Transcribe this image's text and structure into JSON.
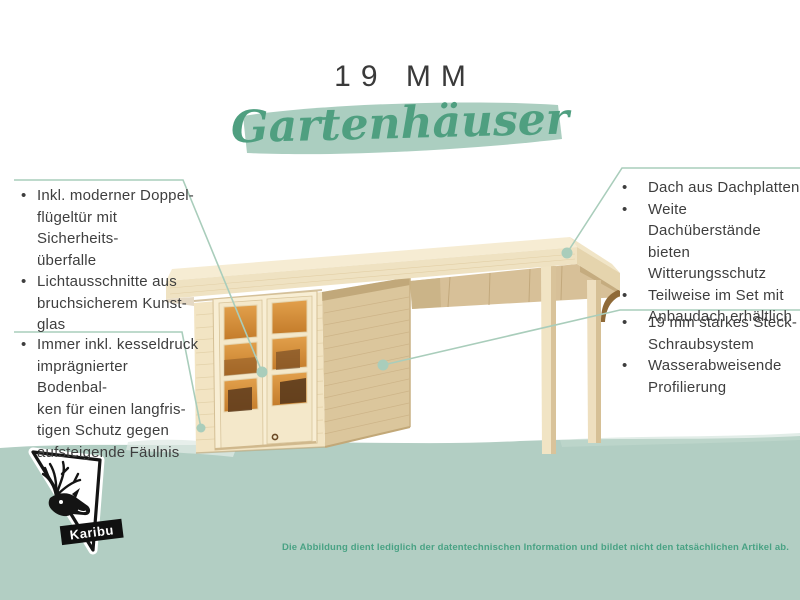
{
  "header": {
    "size_label": "19 MM",
    "product_line": "Gartenhäuser"
  },
  "features": {
    "left_top": [
      "Inkl. moderner Doppel-\nflügeltür mit Sicherheits-\nüberfalle",
      "Lichtausschnitte aus\nbruchsicherem Kunst-\nglas"
    ],
    "left_bottom": [
      "Immer inkl. kesseldruck\nimprägnierter Bodenbal-\nken für einen langfris-\ntigen Schutz gegen\naufsteigende Fäulnis"
    ],
    "right_top": [
      "Dach aus Dachplatten",
      "Weite Dachüberstände\nbieten Witterungsschutz",
      "Teilweise im Set mit\nAnbaudach erhältlich"
    ],
    "right_bottom": [
      "19 mm starkes Steck-\nSchraubsystem",
      "Wasserabweisende\nProfilierung"
    ]
  },
  "logo": {
    "brand": "Karibu"
  },
  "footer": {
    "disclaimer": "Die Abbildung dient lediglich der datentechnischen Information und bildet nicht den tatsächlichen Artikel ab."
  },
  "colors": {
    "accent_green": "#4f9f80",
    "band_green": "#b2cec3",
    "brush_green": "#abcec0",
    "callout_line": "#a9cdbb",
    "text_dark": "#3e3e3e"
  }
}
